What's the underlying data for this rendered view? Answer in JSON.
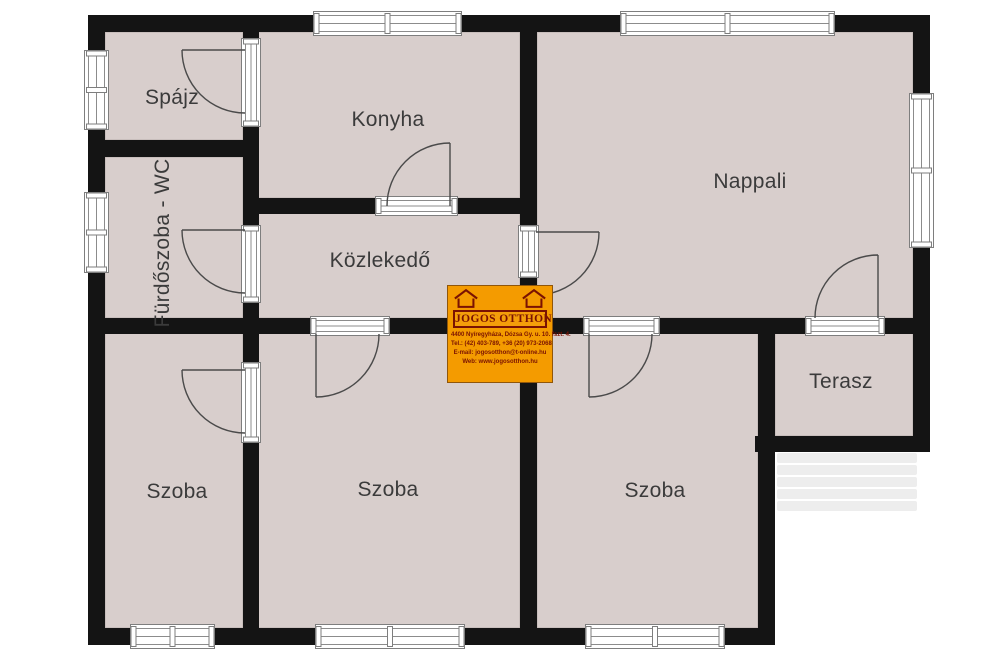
{
  "rooms": {
    "spajz": {
      "label": "Spájz"
    },
    "konyha": {
      "label": "Konyha"
    },
    "nappali": {
      "label": "Nappali"
    },
    "furdoszoba": {
      "label": "Fürdőszoba - WC"
    },
    "kozlekedo": {
      "label": "Közlekedő"
    },
    "terasz": {
      "label": "Terasz"
    },
    "szoba_left": {
      "label": "Szoba"
    },
    "szoba_middle": {
      "label": "Szoba"
    },
    "szoba_right": {
      "label": "Szoba"
    }
  },
  "watermark": {
    "brand": "JOGOS OTTHON",
    "address": "4400 Nyíregyháza, Dózsa Gy. u. 10. fszt. 4.",
    "phone": "Tel.: (42) 403-789, +36 (20) 973-2068",
    "email": "E-mail: jogosotthon@t-online.hu",
    "web": "Web: www.jogosotthon.hu",
    "bg_color": "#f49b00",
    "text_color": "#7a1202"
  },
  "colors": {
    "room_fill": "#d8cecc",
    "room_edge": "#b9aeac",
    "wall": "#141414",
    "fixture_line": "#7e7e7e",
    "door_arc": "#4a4a4a",
    "label_text": "#3b3b3b",
    "stairs": "#ededed"
  }
}
